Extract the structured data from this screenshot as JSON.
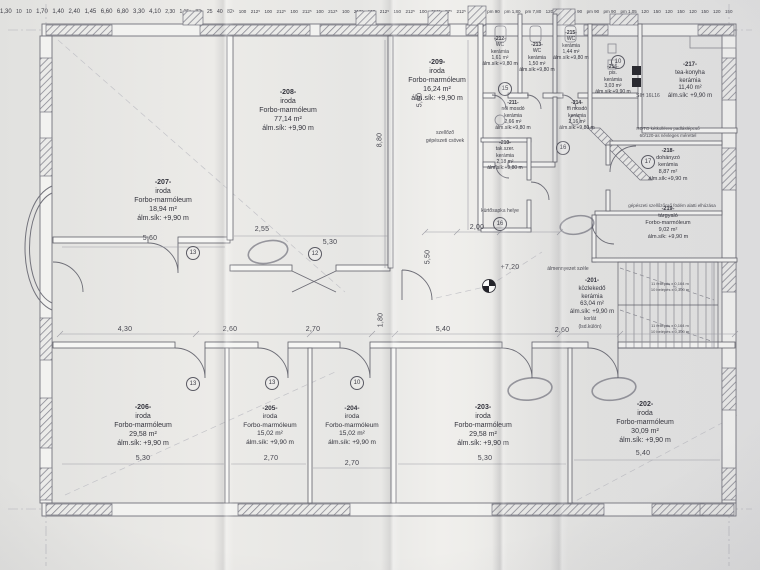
{
  "rooms": [
    {
      "id": "-207-",
      "name": "iroda",
      "floor": "Forbo-marmóleum",
      "area": "18,94 m²",
      "level": "álm.sík: +9,90 m"
    },
    {
      "id": "-208-",
      "name": "iroda",
      "floor": "Forbo-marmóleum",
      "area": "77,14 m²",
      "level": "álm.sík: +9,90 m"
    },
    {
      "id": "-209-",
      "name": "iroda",
      "floor": "Forbo-marmóleum",
      "area": "16,24 m²",
      "level": "álm.sík: +9,90 m"
    },
    {
      "id": "-210-",
      "name": "tak.szer.",
      "floor": "kerámia",
      "area": "2,18 m²",
      "level": "álm.sík:+9,80 m"
    },
    {
      "id": "-211-",
      "name": "női mosdó",
      "floor": "kerámia",
      "area": "2,66 m²",
      "level": "álm.sík:+9,80 m"
    },
    {
      "id": "-212-",
      "name": "WC",
      "floor": "kerámia",
      "area": "1,61 m²",
      "level": "álm.sík:+9,80 m"
    },
    {
      "id": "-213-",
      "name": "WC",
      "floor": "kerámia",
      "area": "1,50 m²",
      "level": "álm.sík:+9,80 m"
    },
    {
      "id": "-214-",
      "name": "ffi mosdó",
      "floor": "kerámia",
      "area": "2,16 m²",
      "level": "álm.sík:+9,80 m"
    },
    {
      "id": "-215-",
      "name": "WC",
      "floor": "kerámia",
      "area": "1,44 m²",
      "level": "álm.sík:+9,80 m"
    },
    {
      "id": "-216-",
      "name": "pis.",
      "floor": "kerámia",
      "area": "3,03 m²",
      "level": "álm.sík:+9,90 m"
    },
    {
      "id": "-217-",
      "name": "tea-konyha",
      "floor": "kerámia",
      "area": "11,40 m²",
      "level": "álm.sík: +9,90 m"
    },
    {
      "id": "-218-",
      "name": "dohányzó",
      "floor": "kerámia",
      "area": "8,87 m²",
      "level": "álm.sík:+9,90 m"
    },
    {
      "id": "-219-",
      "name": "tárgyaló",
      "floor": "Forbo-marmóleum",
      "area": "9,02 m²",
      "level": "álm.sík: +9,90 m"
    },
    {
      "id": "-201-",
      "name": "közlekedő",
      "floor": "kerámia",
      "area": "63,04 m²",
      "level": "álm.sík: +9,90 m"
    },
    {
      "id": "-202-",
      "name": "iroda",
      "floor": "Forbo-marmóleum",
      "area": "30,09 m²",
      "level": "álm.sík: +9,90 m"
    },
    {
      "id": "-203-",
      "name": "iroda",
      "floor": "Forbo-marmóleum",
      "area": "29,58 m²",
      "level": "álm.sík: +9,90 m"
    },
    {
      "id": "-204-",
      "name": "iroda",
      "floor": "Forbo-marmóleum",
      "area": "15,02 m²",
      "level": "álm.sík: +9,90 m"
    },
    {
      "id": "-205-",
      "name": "iroda",
      "floor": "Forbo-marmóleum",
      "area": "15,02 m²",
      "level": "álm.sík: +9,90 m"
    },
    {
      "id": "-206-",
      "name": "iroda",
      "floor": "Forbo-marmóleum",
      "area": "29,58 m²",
      "level": "álm.sík: +9,90 m"
    }
  ],
  "notes": {
    "vent1": "szellőző",
    "vent2": "gépészeti csövek",
    "roto1": "ROTO kétkolléres padláslépcső",
    "roto2": "60/120-as névleges mérettel",
    "duct": "gépészeti szellőzőcső födém alatti elhúzása",
    "ceiling": "álmennyezet széle",
    "rail1": "korlát",
    "rail2": "(lsd.külön)",
    "chimney": "kürtősapka helye",
    "sih": "SIH 16L16",
    "level": "+7,20",
    "stair1": "11 fellépés x 0,164 m",
    "stair2": "10 belépés x 0,300 m"
  },
  "dims": {
    "a430": "4,30",
    "a260": "2,60",
    "a270": "2,70",
    "a180": "1,80",
    "a540": "5,40",
    "a530": "5,30",
    "a560": "5,60",
    "a880": "8,80",
    "a550": "5,50",
    "a240": "2,40",
    "a140": "1,40",
    "a170": "1,70",
    "a145": "1,45",
    "a200": "2,00",
    "a660": "6,60",
    "a255": "2,55",
    "a330": "3,30",
    "a410": "4,10",
    "a230": "2,30",
    "a115": "1,15¹",
    "a130": "1,30",
    "a10": "10",
    "a680": "6,80",
    "a82": "82¹",
    "a25": "25",
    "a40": "40",
    "t100": "100",
    "t212": "212⁵",
    "t150": "150",
    "t87": "87⁵",
    "e120": "120",
    "e150": "150",
    "pm90": "pm 90",
    "pm105": "pm 1,05",
    "pm180": "pm 1,80",
    "pm780": "pm 7,80"
  },
  "circles": {
    "n10": "10",
    "n12": "12",
    "n13": "13",
    "n15": "15",
    "n16": "16",
    "n17": "17"
  }
}
